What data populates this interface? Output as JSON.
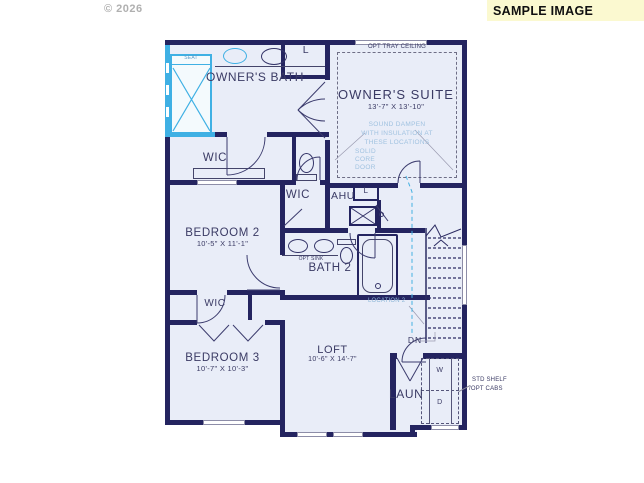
{
  "page": {
    "copyright": "© 2026",
    "banner": "SAMPLE IMAGE"
  },
  "colors": {
    "wall": "#242460",
    "floor": "#e9edf8",
    "highlight_cyan": "#3fb0e4",
    "note_blue": "#a0c2e0",
    "banner_bg": "#fbf9d0"
  },
  "labels": {
    "opt_tray": "OPT TRAY CEILING",
    "owners_suite": "OWNER'S SUITE",
    "owners_suite_dim": "13'-7\" X 13'-10\"",
    "sound1": "SOUND DAMPEN",
    "sound2": "WITH INSULATION AT",
    "sound3": "THESE LOCATIONS",
    "solid1": "SOLID",
    "solid2": "CORE",
    "solid3": "DOOR",
    "owners_bath": "OWNER'S BATH",
    "seat": "SEAT",
    "linen_top": "L",
    "linen_hall": "L",
    "wic_owner": "WIC",
    "wic_2": "WIC",
    "wic_3": "WIC",
    "ahu": "AHU",
    "bedroom2": "BEDROOM 2",
    "bedroom2_dim": "10'-5\" X 11'-1\"",
    "opt_sink": "OPT SINK",
    "bath2": "BATH 2",
    "location2": "LOCATION 2",
    "dn": "DN",
    "bedroom3": "BEDROOM 3",
    "bedroom3_dim": "10'-7\" X 10'-3\"",
    "loft": "LOFT",
    "loft_dim": "10'-6\" X 14'-7\"",
    "laundry": "LAUN",
    "washer": "W",
    "dryer": "D",
    "shelf1": "STD SHELF",
    "shelf2": "/OPT CABS"
  }
}
